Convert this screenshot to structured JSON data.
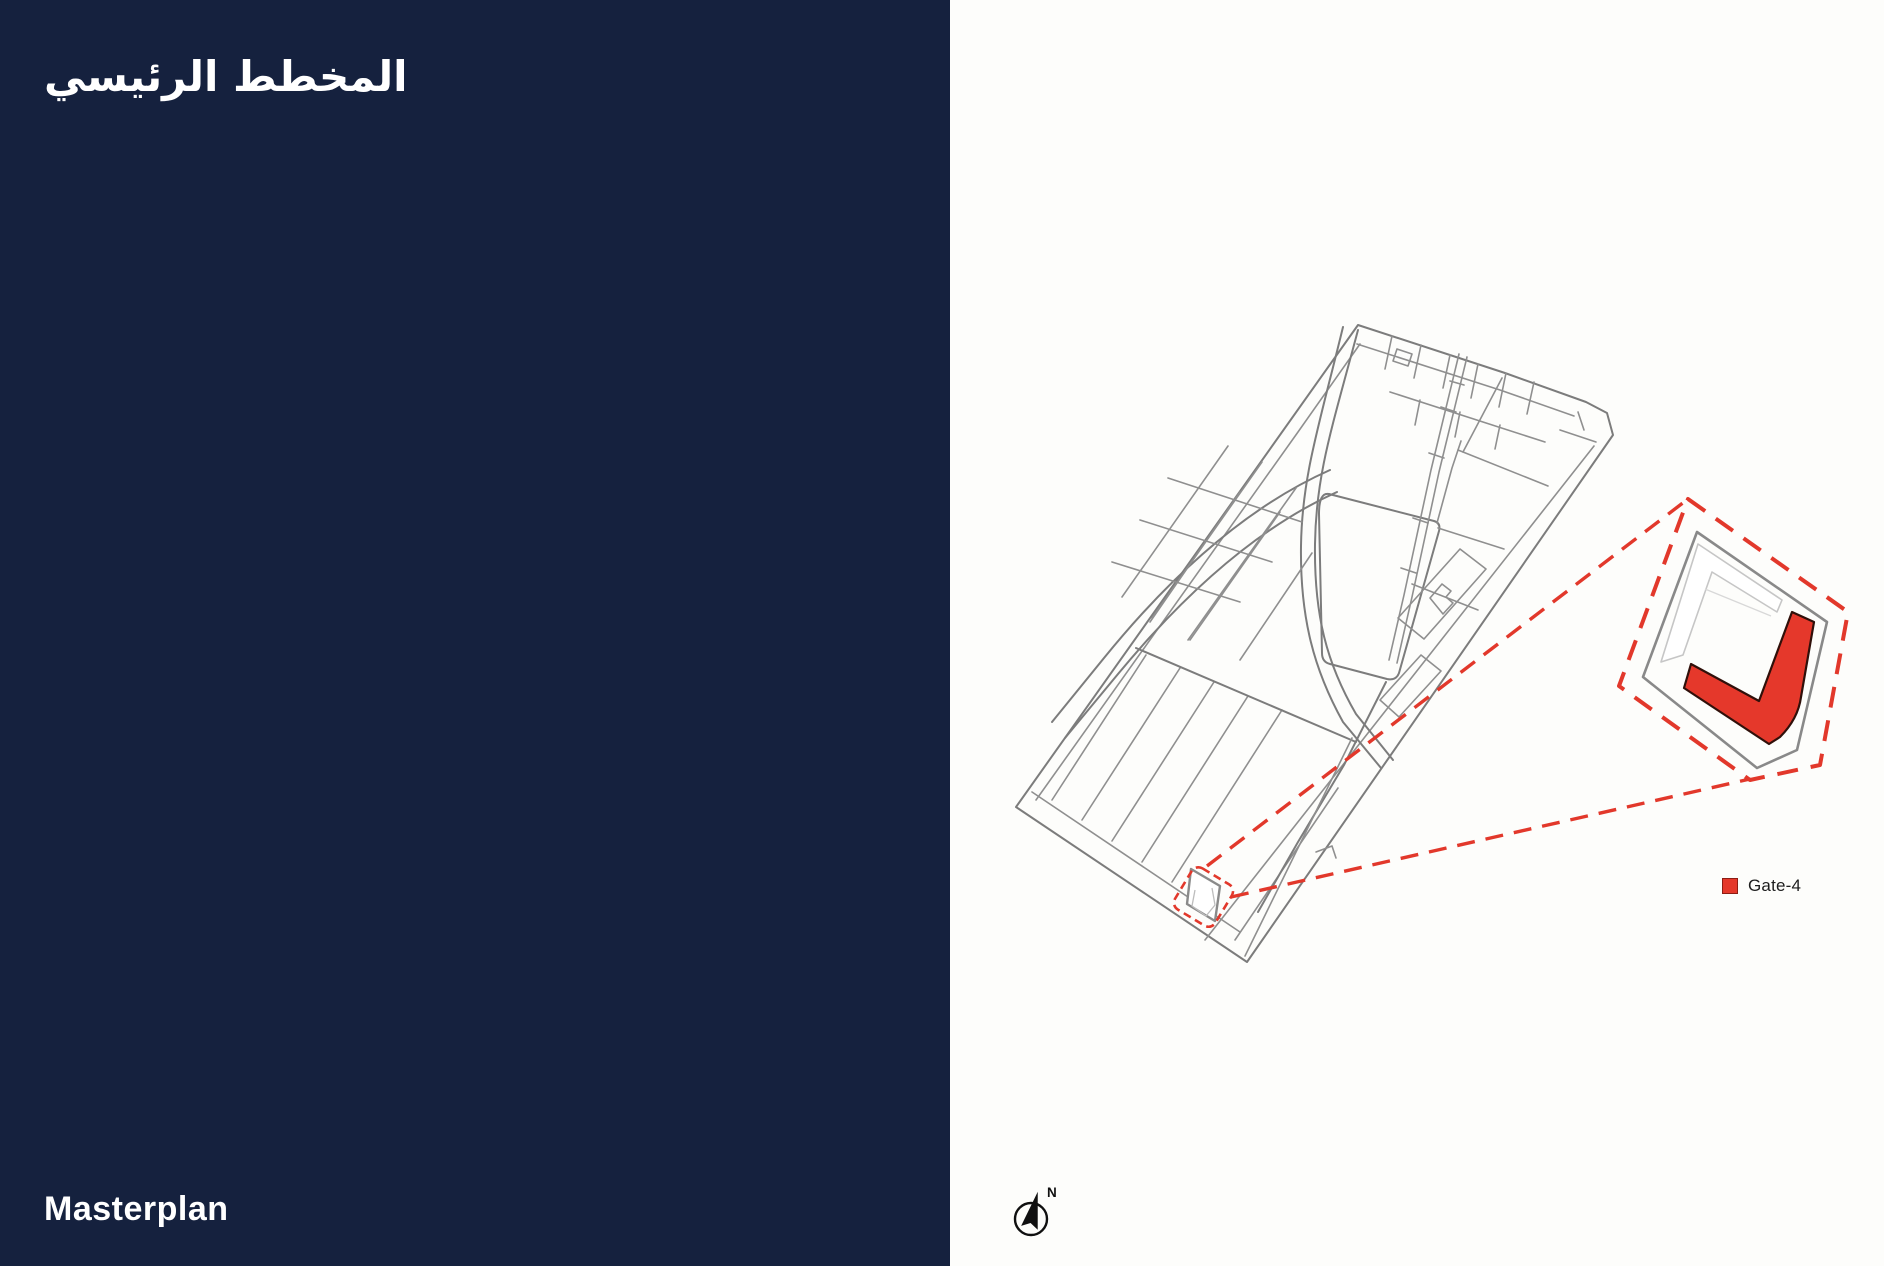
{
  "slide": {
    "title_arabic": "المخطط الرئيسي",
    "title_english": "Masterplan"
  },
  "map": {
    "legend": {
      "label": "Gate-4"
    },
    "compass": {
      "north_label": "N"
    }
  },
  "colors": {
    "navy_panel": "#15213E",
    "background": "#FDFDFB",
    "highlight_red": "#E2382B",
    "building_red_fill": "#E5382B",
    "building_red_outline": "#30100A",
    "map_line_gray": "#7C7C7C",
    "plot_outline_gray": "#8A8A8A",
    "light_outline_gray": "#C6C6C6",
    "text_white": "#FFFFFF",
    "legend_text": "#1D1D1D"
  }
}
